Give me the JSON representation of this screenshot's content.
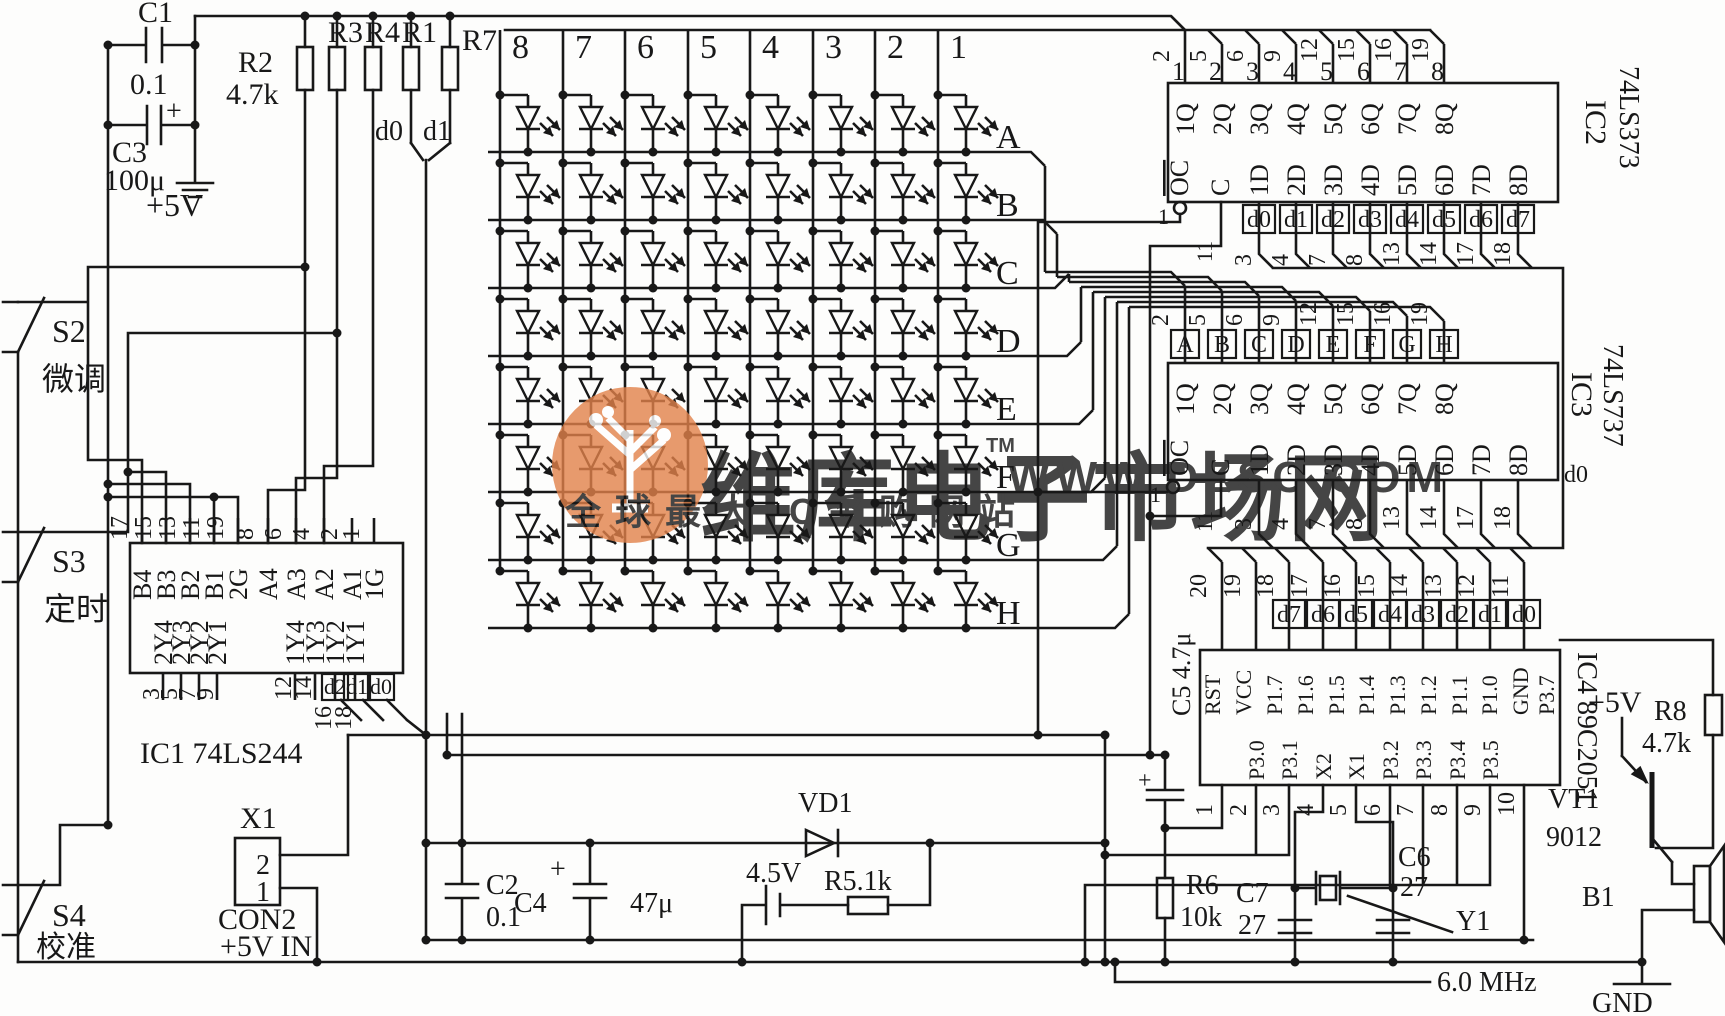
{
  "watermark": {
    "brand": "维库电子市场网",
    "tm": "TM",
    "url": "WWW.DZSC.COM",
    "slogan": "全球最大IC采购网站",
    "color": "#e2824a"
  },
  "power": {
    "c1": "C1",
    "c1_value": "0.1",
    "c3": "C3",
    "c3_value": "100μ",
    "plus": "+",
    "rail": "+5V"
  },
  "pullups": {
    "r2": "R2",
    "r2_value": "4.7k",
    "r3": "R3",
    "r4": "R4",
    "r1": "R1",
    "r7": "R7",
    "d0": "d0",
    "d1": "d1"
  },
  "matrix": {
    "columns": [
      "8",
      "7",
      "6",
      "5",
      "4",
      "3",
      "2",
      "1"
    ],
    "rows": [
      "A",
      "B",
      "C",
      "D",
      "E",
      "F",
      "G",
      "H"
    ]
  },
  "ic1": {
    "name": "IC1 74LS244",
    "top_pins": [
      "17",
      "15",
      "13",
      "11",
      "19",
      "8",
      "6",
      "4",
      "2",
      "1"
    ],
    "top_labels": [
      "B4",
      "B3",
      "B2",
      "B1",
      "2G",
      "A4",
      "A3",
      "A2",
      "A1",
      "1G"
    ],
    "bottom_labels": [
      "2Y4",
      "2Y3",
      "2Y2",
      "2Y1",
      "1Y4",
      "1Y3",
      "1Y2",
      "1Y1"
    ],
    "bottom_pins": [
      "3",
      "5",
      "7",
      "9",
      "12",
      "14",
      "16",
      "18"
    ],
    "data_tags": [
      "d2",
      "d1",
      "d0"
    ]
  },
  "ic2": {
    "name": "IC2",
    "part": "74LS373",
    "top_pins": [
      "2",
      "5",
      "6",
      "9",
      "12",
      "15",
      "16",
      "19"
    ],
    "top_index": [
      "1",
      "2",
      "3",
      "4",
      "5",
      "6",
      "7",
      "8"
    ],
    "q_labels": [
      "1Q",
      "2Q",
      "3Q",
      "4Q",
      "5Q",
      "6Q",
      "7Q",
      "8Q"
    ],
    "oc": "OC",
    "c": "C",
    "oc_pin": "1",
    "c_pin": "11",
    "d_labels": [
      "1D",
      "2D",
      "3D",
      "4D",
      "5D",
      "6D",
      "7D",
      "8D"
    ],
    "data_tags": [
      "d0",
      "d1",
      "d2",
      "d3",
      "d4",
      "d5",
      "d6",
      "d7"
    ],
    "bottom_pins": [
      "3",
      "4",
      "7",
      "8",
      "13",
      "14",
      "17",
      "18"
    ]
  },
  "ic3": {
    "name": "IC3",
    "part": "74LS737",
    "row_tags": [
      "A",
      "B",
      "C",
      "D",
      "E",
      "F",
      "G",
      "H"
    ],
    "top_pins": [
      "2",
      "5",
      "6",
      "9",
      "12",
      "15",
      "16",
      "19"
    ],
    "q_labels": [
      "1Q",
      "2Q",
      "3Q",
      "4Q",
      "5Q",
      "6Q",
      "7Q",
      "8Q"
    ],
    "oc": "OC",
    "c": "C",
    "oc_pin": "1",
    "c_pin": "11",
    "d_labels": [
      "1D",
      "2D",
      "3D",
      "4D",
      "5D",
      "6D",
      "7D",
      "8D"
    ],
    "bottom_pins": [
      "3",
      "4",
      "7",
      "8",
      "13",
      "14",
      "17",
      "18"
    ],
    "d0_note": "d0"
  },
  "ic4": {
    "name": "IC4 89C2051",
    "c5": "C5 4.7μ",
    "c5_plus": "+",
    "top_pins": [
      "20",
      "19",
      "18",
      "17",
      "16",
      "15",
      "14",
      "13",
      "12",
      "11"
    ],
    "data_tags": [
      "d7",
      "d6",
      "d5",
      "d4",
      "d3",
      "d2",
      "d1",
      "d0"
    ],
    "top_labels": [
      "RST",
      "VCC",
      "P1.7",
      "P1.6",
      "P1.5",
      "P1.4",
      "P1.3",
      "P1.2",
      "P1.1",
      "P1.0",
      "GND",
      "P3.7"
    ],
    "bottom_labels": [
      "P3.0",
      "P3.1",
      "X2",
      "X1",
      "P3.2",
      "P3.3",
      "P3.4",
      "P3.5"
    ],
    "bottom_pins": [
      "1",
      "2",
      "3",
      "4",
      "5",
      "6",
      "7",
      "8",
      "9",
      "10"
    ]
  },
  "switches": {
    "s2": "S2",
    "s2_cn": "微调",
    "s3": "S3",
    "s3_cn": "定时",
    "s4": "S4",
    "s4_cn": "校准"
  },
  "connector": {
    "name": "X1",
    "pin2": "2",
    "pin1": "1",
    "type": "CON2",
    "note": "+5V IN"
  },
  "bottom": {
    "c2": "C2",
    "c2_value": "0.1",
    "c4": "C4",
    "c4_plus": "+",
    "c4_value": "47μ",
    "vd1": "VD1",
    "battery": "4.5V",
    "r5": "R5.1k",
    "r6": "R6",
    "r6_value": "10k",
    "c7": "C7",
    "c7_value": "27",
    "c6": "C6",
    "c6_value": "27",
    "y1": "Y1",
    "freq": "6.0 MHz"
  },
  "output": {
    "vcc": "+5V",
    "r8": "R8",
    "r8_value": "4.7k",
    "vt1": "VT1",
    "vt1_part": "9012",
    "b1": "B1",
    "gnd": "GND"
  }
}
